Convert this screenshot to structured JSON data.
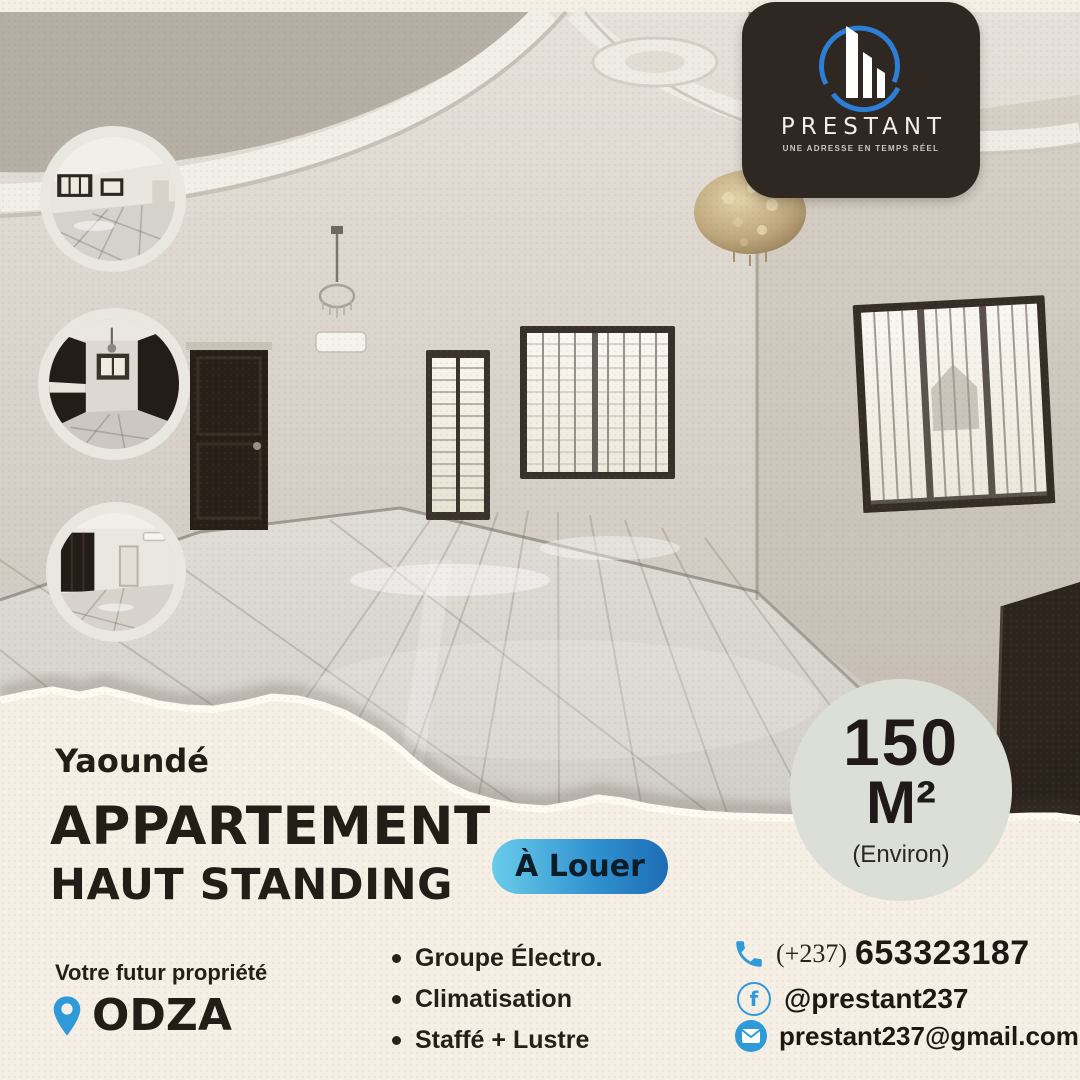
{
  "brand": {
    "name": "PRESTANT",
    "tagline": "UNE ADRESSE EN TEMPS RÉEL"
  },
  "listing": {
    "city": "Yaoundé",
    "title_line1": "APPARTEMENT",
    "title_line2": "HAUT STANDING",
    "status_label": "À Louer",
    "area_value": "150",
    "area_unit": "M²",
    "area_note": "(Environ)",
    "future_label": "Votre futur propriété",
    "neighborhood": "ODZA"
  },
  "features": {
    "items": [
      {
        "label": "Groupe Électro."
      },
      {
        "label": "Climatisation"
      },
      {
        "label": "Staffé + Lustre"
      }
    ]
  },
  "contact": {
    "phone_prefix": "(+237)",
    "phone_number": "653323187",
    "facebook": "@prestant237",
    "email": "prestant237@gmail.com"
  },
  "icons": {
    "phone": "phone-handset",
    "facebook_letter": "f",
    "mail": "envelope",
    "location": "map-pin"
  },
  "colors": {
    "accent_blue": "#2e9ad8",
    "button_gradient_start": "#6accea",
    "button_gradient_end": "#1e6db5",
    "paper": "#f6efe5",
    "logo_panel": "#2f2722",
    "badge_bg": "#dcdfd7",
    "text_dark": "#241d17"
  }
}
